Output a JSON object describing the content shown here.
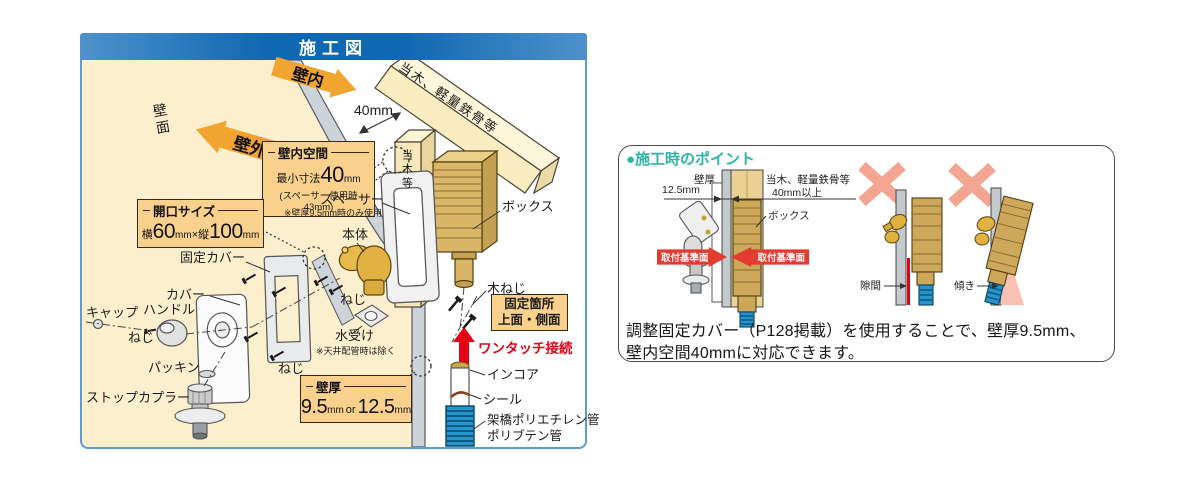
{
  "colors": {
    "panel_border_blue": "#5b9cd2",
    "title_bar_blue": "#1168b2",
    "wall_beige": "#fcefcd",
    "zone_arrow_orange": "#f1a42f",
    "spec_box_orange": "#f9d18d",
    "accent_red": "#e60012",
    "datum_arrow_red": "#e23c30",
    "heading_teal": "#2db5a2",
    "ng_cross_salmon": "#f4a591",
    "pipe_blue": "#2596ca"
  },
  "main_panel": {
    "title": "施工図",
    "zones": {
      "inside": "壁内",
      "outside": "壁外",
      "wall_face": "壁面"
    },
    "dim_40mm": "40mm",
    "beam": "当木、軽量鉄骨等",
    "post": "当木等",
    "boxes": {
      "cavity": {
        "title": "壁内空間",
        "prefix": "最小寸法",
        "value": "40",
        "unit": "mm",
        "note": "(スペーサー使用時43mm)"
      },
      "opening": {
        "title": "開口サイズ",
        "w_prefix": "横",
        "w_value": "60",
        "w_unit": "mm",
        "times": "×",
        "h_prefix": "縦",
        "h_value": "100",
        "h_unit": "mm"
      },
      "thickness": {
        "title": "壁厚",
        "v1": "9.5",
        "u1": "mm",
        "or": "or",
        "v2": "12.5",
        "u2": "mm"
      },
      "fixing": {
        "line1": "固定箇所",
        "line2": "上面・側面"
      }
    },
    "parts": {
      "spacer": "スペーサー",
      "spacer_note": "※壁厚9.5mm時のみ使用",
      "body": "本体",
      "box": "ボックス",
      "fixed_cover": "固定カバー",
      "cover": "カバー",
      "cap": "キャップ",
      "handle": "ハンドル",
      "screw_a": "ねじ",
      "screw_b": "ねじ",
      "screw_c": "ねじ",
      "packing": "パッキン",
      "stop_coupler": "ストップカプラー",
      "water_receiver": "水受け",
      "water_receiver_note": "※天井配管時は除く",
      "wood_screw": "木ねじ",
      "one_touch": "ワンタッチ接続",
      "incore": "インコア",
      "seal": "シール",
      "pipe_pex": "架橋ポリエチレン管",
      "pipe_pb": "ポリブテン管"
    }
  },
  "points_panel": {
    "heading": "●施工時のポイント",
    "detail": {
      "wall_thickness_label": "壁厚",
      "wall_thickness_value": "12.5mm",
      "backing_label": "当木、軽量鉄骨等",
      "backing_value": "40mm以上",
      "box_label": "ボックス",
      "datum_left": "取付基準面",
      "datum_right": "取付基準面"
    },
    "ng_gap": "隙間",
    "ng_tilt": "傾き",
    "note_line1": "調整固定カバー（P128掲載）を使用することで、壁厚9.5mm、",
    "note_line2": "壁内空間40mmに対応できます。"
  }
}
